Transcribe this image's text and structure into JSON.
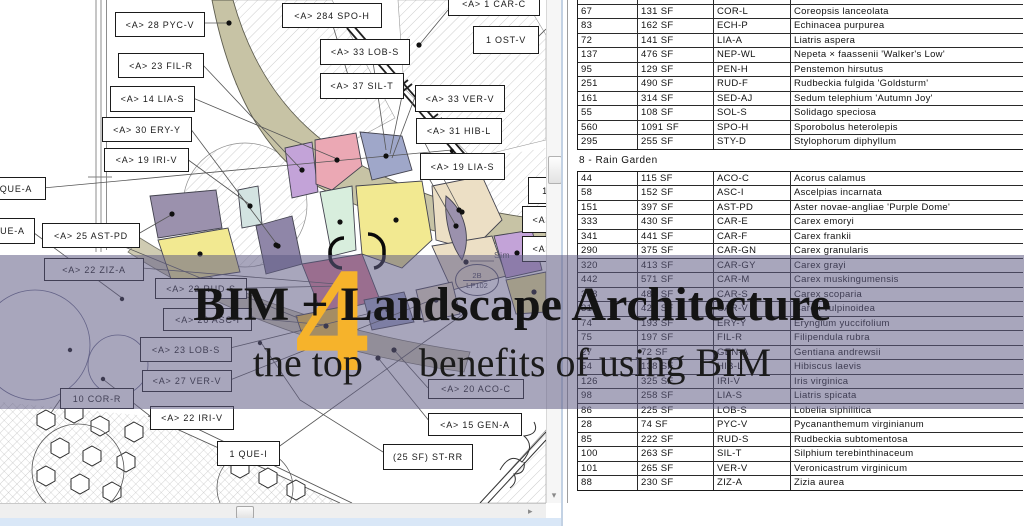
{
  "banner": {
    "title": "BIM + Landscape Architecture",
    "subtitle_left": "the top",
    "big_number": "4",
    "subtitle_right": "benefits of using BIM",
    "accent_color": "#F6B32B",
    "overlay_color": "#61598533"
  },
  "icons": {
    "down_arrow": "▾",
    "right_arrow": "▸"
  },
  "drawing": {
    "sim_label": "Sim",
    "detail_ref": {
      "top": "2B",
      "bottom": "LP102"
    },
    "callouts": [
      {
        "t": "<A>  28 PYC-V",
        "x": 115,
        "y": 12,
        "w": 88,
        "h": 23
      },
      {
        "t": "<A>  284 SPO-H",
        "x": 282,
        "y": 3,
        "w": 98,
        "h": 23
      },
      {
        "t": "<A>  1  CAR-C",
        "x": 448,
        "y": -8,
        "w": 90,
        "h": 22
      },
      {
        "t": "1  OST-V",
        "x": 473,
        "y": 26,
        "w": 64,
        "h": 26
      },
      {
        "t": "<A>  33 LOB-S",
        "x": 320,
        "y": 39,
        "w": 88,
        "h": 24
      },
      {
        "t": "<A>  23 FIL-R",
        "x": 118,
        "y": 53,
        "w": 84,
        "h": 23
      },
      {
        "t": "<A>  37 SIL-T",
        "x": 320,
        "y": 73,
        "w": 82,
        "h": 24
      },
      {
        "t": "<A>  14 LIA-S",
        "x": 110,
        "y": 86,
        "w": 83,
        "h": 24
      },
      {
        "t": "<A>  33 VER-V",
        "x": 415,
        "y": 85,
        "w": 88,
        "h": 25
      },
      {
        "t": "<A>  30 ERY-Y",
        "x": 102,
        "y": 117,
        "w": 88,
        "h": 23
      },
      {
        "t": "<A>  31 HIB-L",
        "x": 416,
        "y": 118,
        "w": 84,
        "h": 24
      },
      {
        "t": "<A>  19 IRI-V",
        "x": 104,
        "y": 148,
        "w": 83,
        "h": 22
      },
      {
        "t": "<A>  19 LIA-S",
        "x": 420,
        "y": 153,
        "w": 83,
        "h": 25
      },
      {
        "t": "QUE-A",
        "x": -14,
        "y": 177,
        "w": 58,
        "h": 21
      },
      {
        "t": "UE-A",
        "x": -10,
        "y": 218,
        "w": 43,
        "h": 24
      },
      {
        "t": "<A>  25 AST-PD",
        "x": 42,
        "y": 223,
        "w": 96,
        "h": 23
      },
      {
        "t": "<A>  22 ZIZ-A",
        "x": 44,
        "y": 258,
        "w": 98,
        "h": 21
      },
      {
        "t": "<A>  22 RUD-S",
        "x": 155,
        "y": 278,
        "w": 90,
        "h": 19
      },
      {
        "t": "<A>  26 ASC-I",
        "x": 163,
        "y": 308,
        "w": 87,
        "h": 21
      },
      {
        "t": "<A>  23 LOB-S",
        "x": 140,
        "y": 337,
        "w": 90,
        "h": 23
      },
      {
        "t": "<A>  27 VER-V",
        "x": 142,
        "y": 370,
        "w": 88,
        "h": 20
      },
      {
        "t": "10  COR-R",
        "x": 60,
        "y": 388,
        "w": 72,
        "h": 19
      },
      {
        "t": "<A>  22 IRI-V",
        "x": 150,
        "y": 406,
        "w": 82,
        "h": 22
      },
      {
        "t": "<A>  20 ACO-C",
        "x": 428,
        "y": 379,
        "w": 94,
        "h": 18
      },
      {
        "t": "<A>  15 GEN-A",
        "x": 428,
        "y": 413,
        "w": 92,
        "h": 21
      },
      {
        "t": "1  QUE-I",
        "x": 217,
        "y": 441,
        "w": 61,
        "h": 23
      },
      {
        "t": "(25 SF) ST-RR",
        "x": 383,
        "y": 444,
        "w": 88,
        "h": 24
      },
      {
        "t": "1",
        "x": 528,
        "y": 177,
        "w": 32,
        "h": 25
      },
      {
        "t": "<A>",
        "x": 522,
        "y": 206,
        "w": 38,
        "h": 25
      },
      {
        "t": "<A>",
        "x": 522,
        "y": 236,
        "w": 38,
        "h": 24
      }
    ]
  },
  "schedule": {
    "sections": [
      {
        "header": null,
        "rows": [
          [
            "",
            "",
            "",
            ""
          ],
          [
            "67",
            "131 SF",
            "COR-L",
            "Coreopsis lanceolata"
          ],
          [
            "83",
            "162 SF",
            "ECH-P",
            "Echinacea purpurea"
          ],
          [
            "72",
            "141 SF",
            "LIA-A",
            "Liatris aspera"
          ],
          [
            "137",
            "476 SF",
            "NEP-WL",
            "Nepeta × faassenii 'Walker's Low'"
          ],
          [
            "95",
            "129 SF",
            "PEN-H",
            "Penstemon hirsutus"
          ],
          [
            "251",
            "490 SF",
            "RUD-F",
            "Rudbeckia fulgida 'Goldsturm'"
          ],
          [
            "161",
            "314 SF",
            "SED-AJ",
            "Sedum telephium 'Autumn Joy'"
          ],
          [
            "55",
            "108 SF",
            "SOL-S",
            "Solidago speciosa"
          ],
          [
            "560",
            "1091 SF",
            "SPO-H",
            "Sporobolus heterolepis"
          ],
          [
            "295",
            "255 SF",
            "STY-D",
            "Stylophorum diphyllum"
          ]
        ]
      },
      {
        "header": "8 - Rain Garden",
        "rows": [
          [
            "44",
            "115 SF",
            "ACO-C",
            "Acorus calamus"
          ],
          [
            "58",
            "152 SF",
            "ASC-I",
            "Ascelpias incarnata"
          ],
          [
            "151",
            "397 SF",
            "AST-PD",
            "Aster novae-angliae 'Purple Dome'"
          ],
          [
            "333",
            "430 SF",
            "CAR-E",
            "Carex emoryi"
          ],
          [
            "341",
            "441 SF",
            "CAR-F",
            "Carex frankii"
          ],
          [
            "290",
            "375 SF",
            "CAR-GN",
            "Carex granularis"
          ],
          [
            "320",
            "413 SF",
            "CAR-GY",
            "Carex grayi"
          ],
          [
            "442",
            "571 SF",
            "CAR-M",
            "Carex muskingumensis"
          ],
          [
            "358",
            "489 SF",
            "CAR-S",
            "Carex scoparia"
          ],
          [
            "312",
            "428 SF",
            "CAR-V",
            "Carex vulpinoidea"
          ],
          [
            "74",
            "193 SF",
            "ERY-Y",
            "Eryngium yuccifolium"
          ],
          [
            "75",
            "197 SF",
            "FIL-R",
            "Filipendula rubra"
          ],
          [
            "27",
            "72 SF",
            "GEN-A",
            "Gentiana andrewsii"
          ],
          [
            "54",
            "138 SF",
            "HIB-L",
            "Hibiscus laevis"
          ],
          [
            "126",
            "325 SF",
            "IRI-V",
            "Iris virginica"
          ],
          [
            "98",
            "258 SF",
            "LIA-S",
            "Liatris spicata"
          ],
          [
            "86",
            "225 SF",
            "LOB-S",
            "Lobelia siphilitica"
          ],
          [
            "28",
            "74 SF",
            "PYC-V",
            "Pycananthemum virginianum"
          ],
          [
            "85",
            "222 SF",
            "RUD-S",
            "Rudbeckia subtomentosa"
          ],
          [
            "100",
            "263 SF",
            "SIL-T",
            "Silphium terebinthinaceum"
          ],
          [
            "101",
            "265 SF",
            "VER-V",
            "Veronicastrum virginicum"
          ],
          [
            "88",
            "230 SF",
            "ZIZ-A",
            "Zizia aurea"
          ]
        ]
      }
    ]
  }
}
